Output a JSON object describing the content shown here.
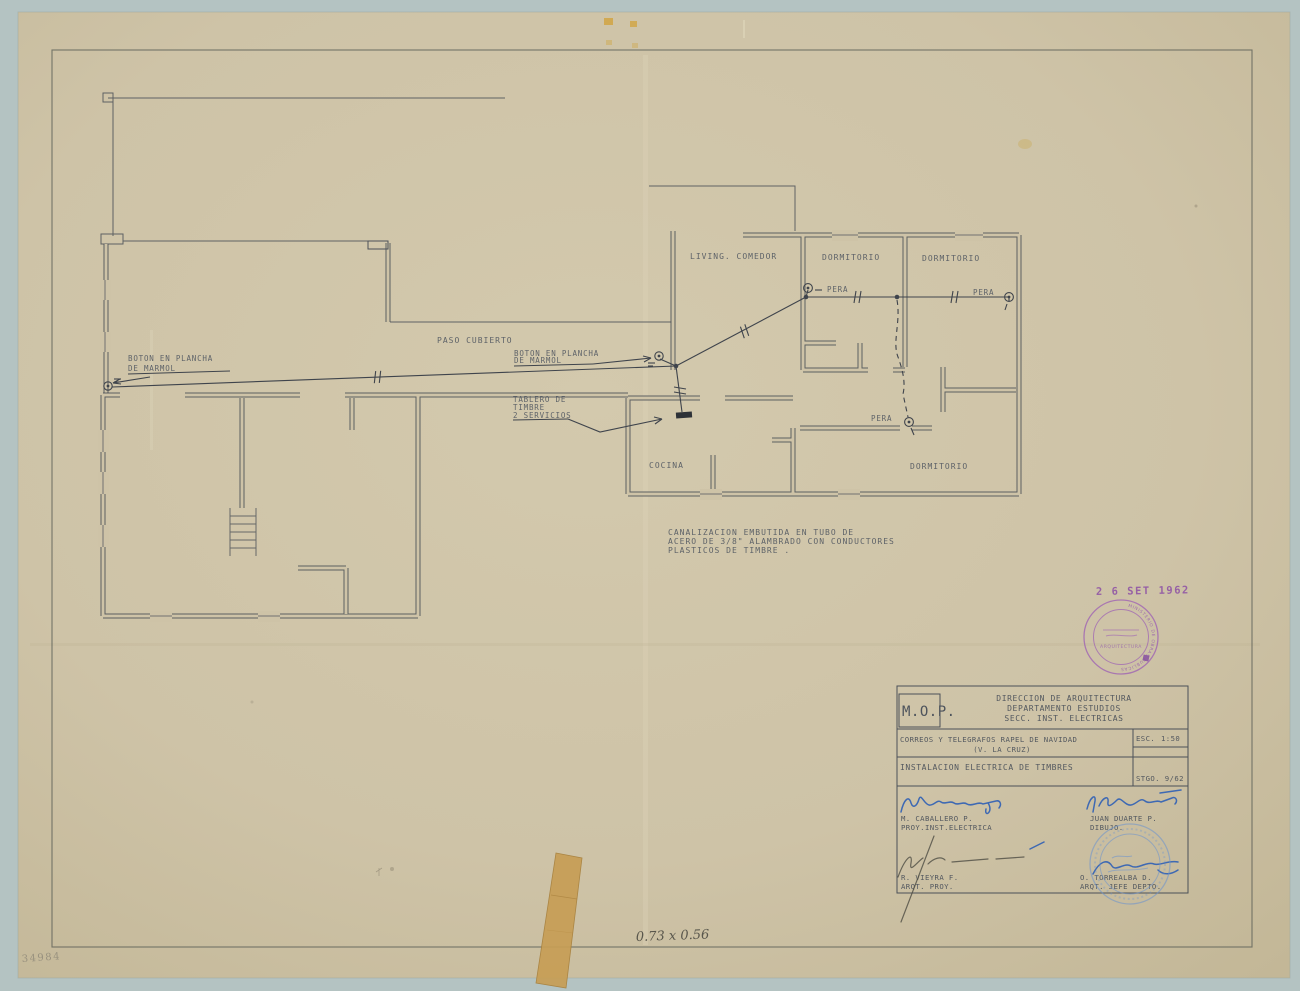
{
  "scene": {
    "background_color": "#b4c3c2",
    "paper_color": "#cec3a7",
    "ink_color": "#4b5058",
    "purple_stamp_color": "#9155ae",
    "blue_ink_color": "#2f5fb5"
  },
  "plan": {
    "rooms": {
      "living": "LIVING. COMEDOR",
      "dormitorio_1": "DORMITORIO",
      "dormitorio_2": "DORMITORIO",
      "dormitorio_3": "DORMITORIO",
      "cocina": "COCINA",
      "paso_cubierto": "PASO CUBIERTO"
    },
    "wiring": {
      "pera_label": "PERA",
      "boton_line1": "BOTON EN PLANCHA",
      "boton_line2": "DE MARMOL",
      "tablero_line1": "TABLERO DE",
      "tablero_line2": "TIMBRE",
      "tablero_line3": "2 SERVICIOS"
    },
    "note_line1": "CANALIZACION EMBUTIDA EN TUBO DE",
    "note_line2": "ACERO DE 3/8\" ALAMBRADO CON CONDUCTORES",
    "note_line3": "PLASTICOS DE TIMBRE ."
  },
  "title_block": {
    "org": "M.O.P.",
    "dept_line1": "DIRECCION DE ARQUITECTURA",
    "dept_line2": "DEPARTAMENTO ESTUDIOS",
    "dept_line3": "SECC. INST. ELECTRICAS",
    "project_line1": "CORREOS Y TELEGRAFOS RAPEL DE NAVIDAD",
    "project_line2": "(V. LA CRUZ)",
    "scale_label": "ESC.",
    "scale_value": "1:50",
    "subject": "INSTALACION ELECTRICA DE TIMBRES",
    "plan_ref": "STGO. 9/62",
    "sig1_name": "M. CABALLERO P.",
    "sig1_role": "PROY.INST.ELECTRICA",
    "sig2_name": "JUAN DUARTE P.",
    "sig2_role": "DIBUJO.",
    "sig3_name": "R. VIEYRA F.",
    "sig3_role": "ARQT. PROY.",
    "sig4_name": "O. TORREALBA D.",
    "sig4_role": "ARQT. JEFE DEPTO."
  },
  "stamps": {
    "date_stamp": "2 6 SET 1962",
    "round_stamp_ring": "MINISTERIO DE OBRAS PUBLICAS",
    "round_stamp_inner": "ARQUITECTURA"
  },
  "margin_notes": {
    "size_note": "0.73 x 0.56",
    "archive_number": "34984"
  }
}
